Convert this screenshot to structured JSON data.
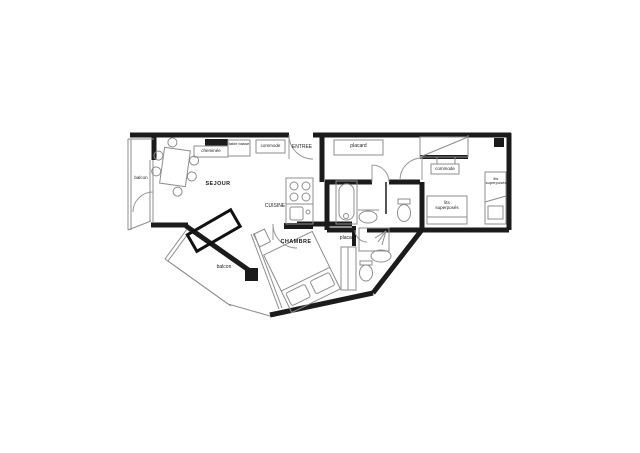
{
  "floorplan": {
    "type": "apartment-floor-plan",
    "colors": {
      "wall": "#1b1b1b",
      "thin_line": "#8d8d8d",
      "background": "#ffffff"
    },
    "rooms": {
      "sejour": "SEJOUR",
      "cuisine": "CUISINE",
      "chambre": "CHAMBRE",
      "entree": "ENTREE",
      "balcon_left": "balcon",
      "balcon_bottom": "balcon"
    },
    "furniture_labels": {
      "cheminee": "cheminée",
      "table_basse": "table basse",
      "commode_sejour": "commode",
      "placard_hall": "placard",
      "placard_chambre": "placard",
      "commode_chambre": "commode",
      "lits_superposes_1": "lits superposés",
      "lits_superposes_2": "lits superposés"
    }
  }
}
